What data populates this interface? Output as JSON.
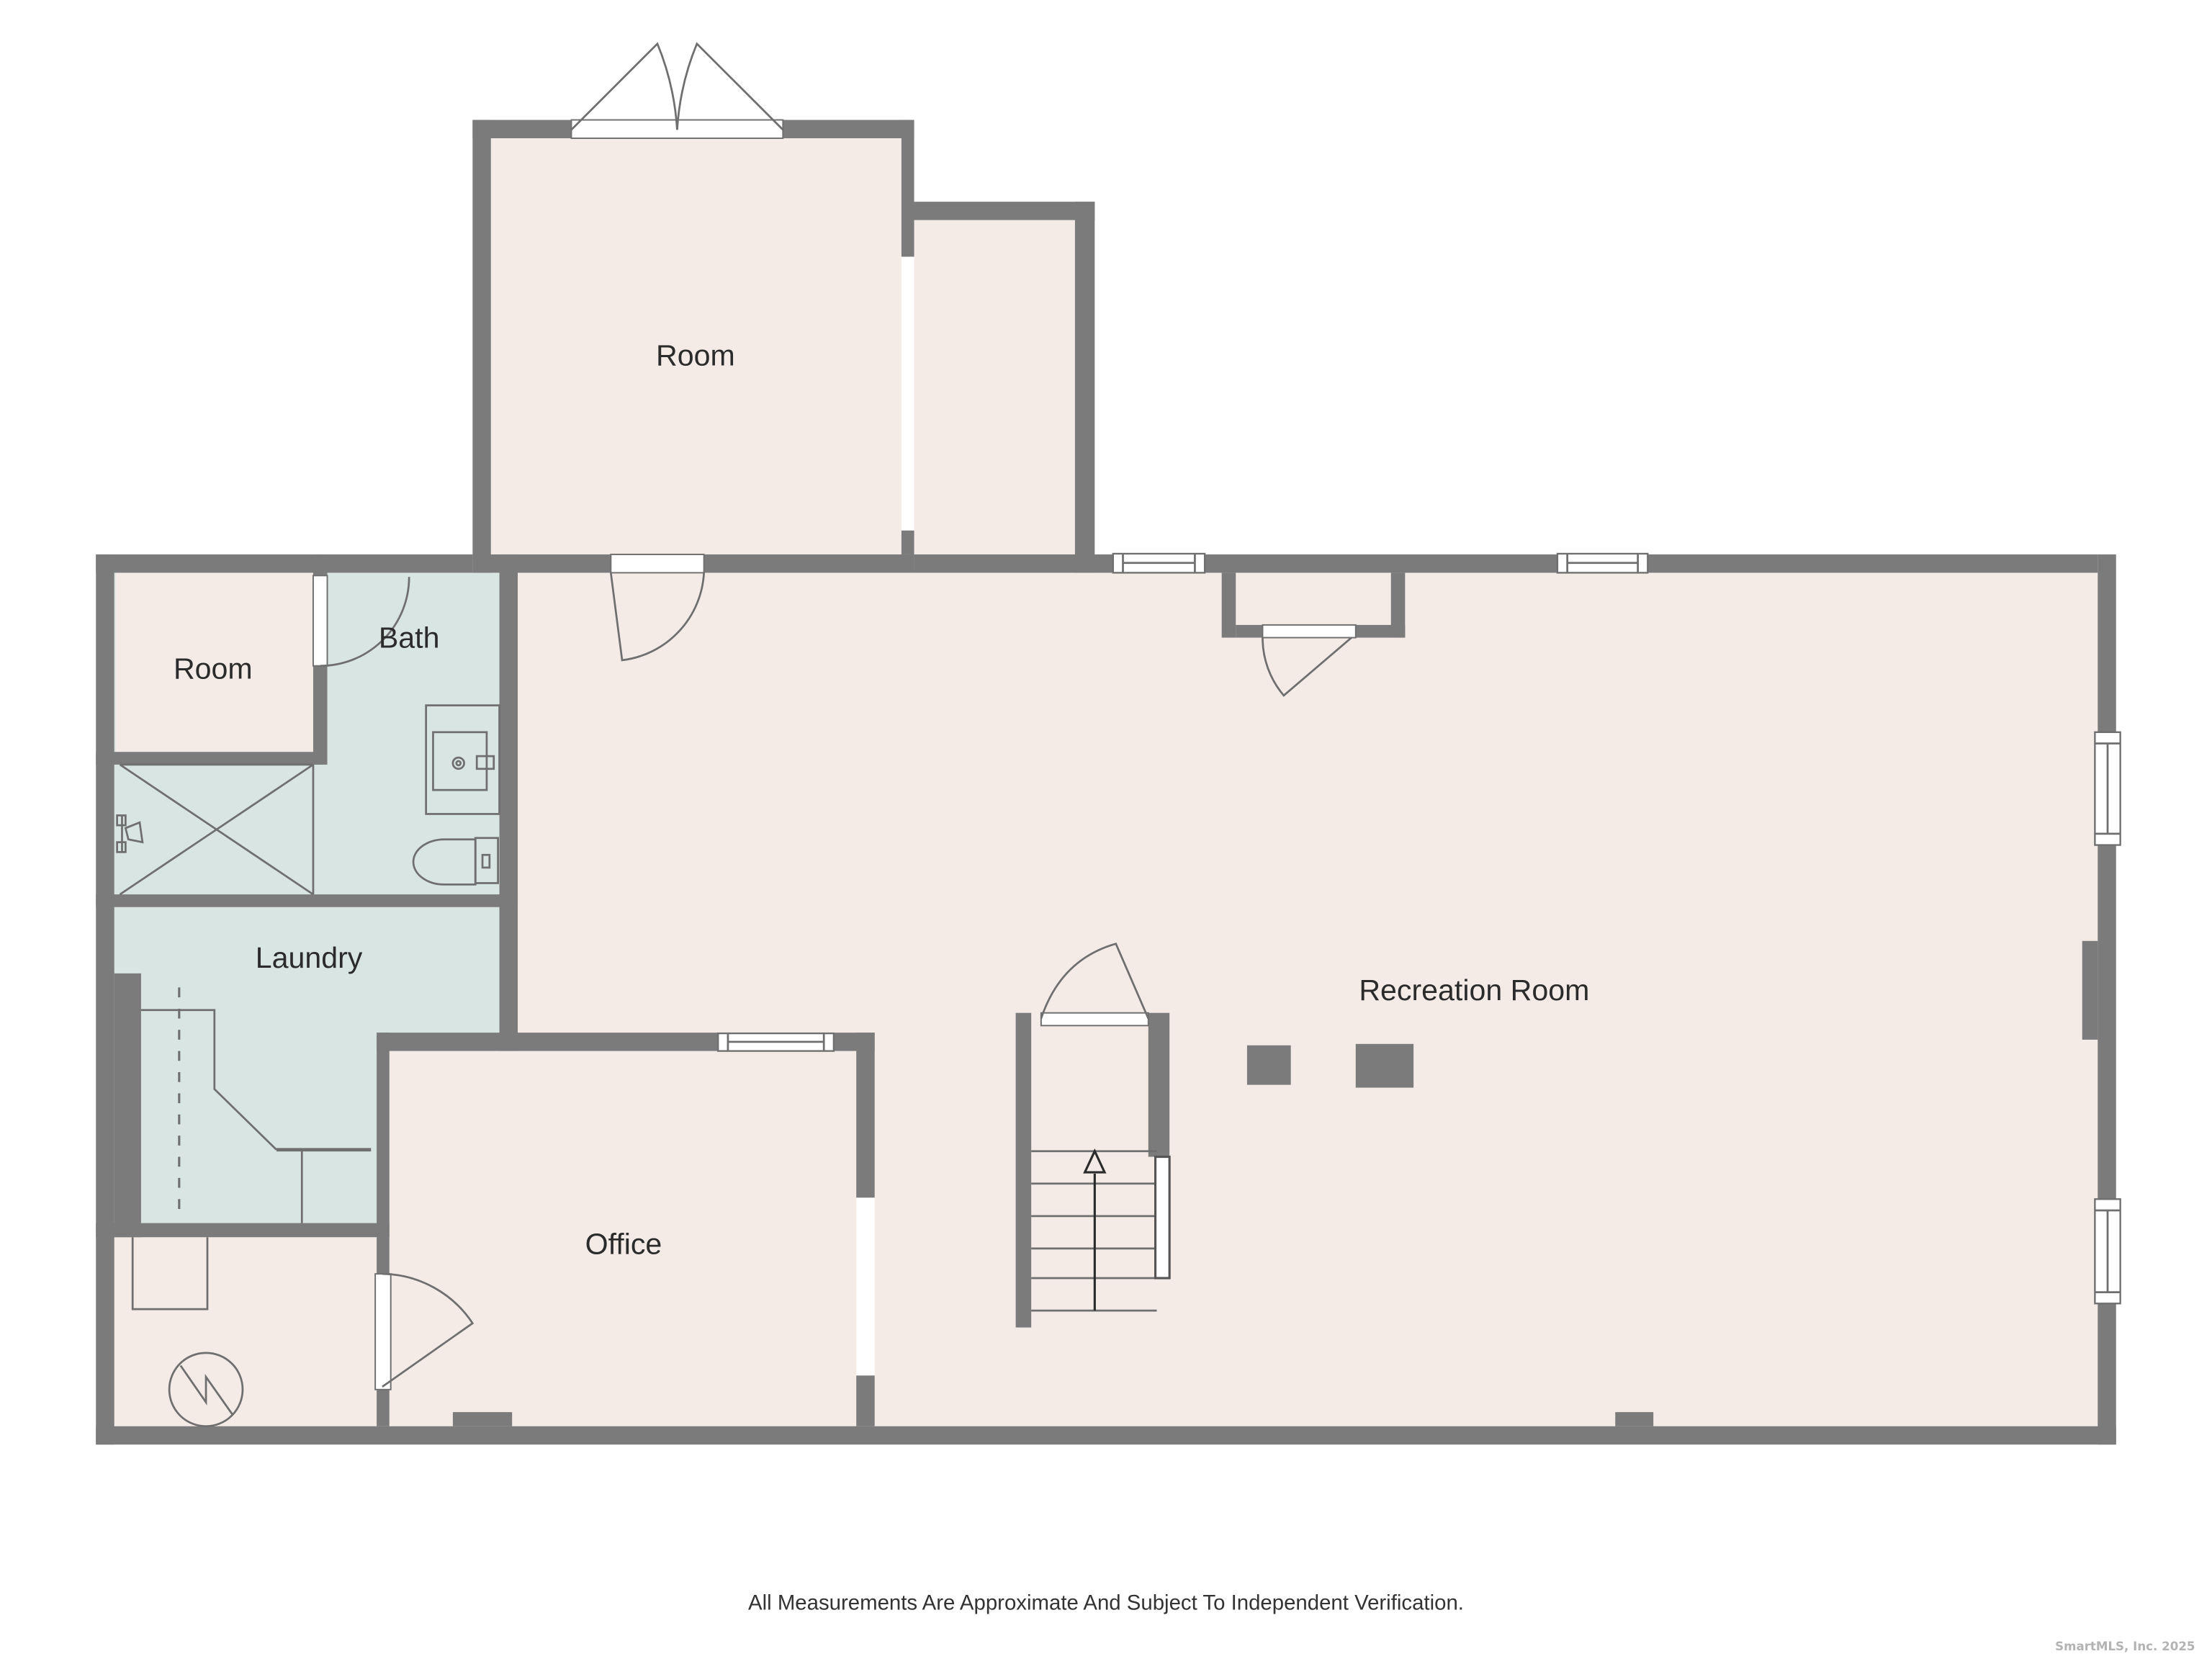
{
  "colors": {
    "bg": "#ffffff",
    "wall": "#7b7b7b",
    "floor": "#f4ebe7",
    "wet": "#d9e5e3",
    "line": "#6f6f6f",
    "text": "#2b2b2b",
    "mark": "#b3b3b3"
  },
  "rooms": {
    "top_room": "Room",
    "side_room": "Room",
    "bath": "Bath",
    "laundry": "Laundry",
    "office": "Office",
    "recreation": "Recreation Room"
  },
  "footer": {
    "disclaimer": "All Measurements Are Approximate And Subject To Independent Verification."
  },
  "watermark": "SmartMLS, Inc.  2025"
}
